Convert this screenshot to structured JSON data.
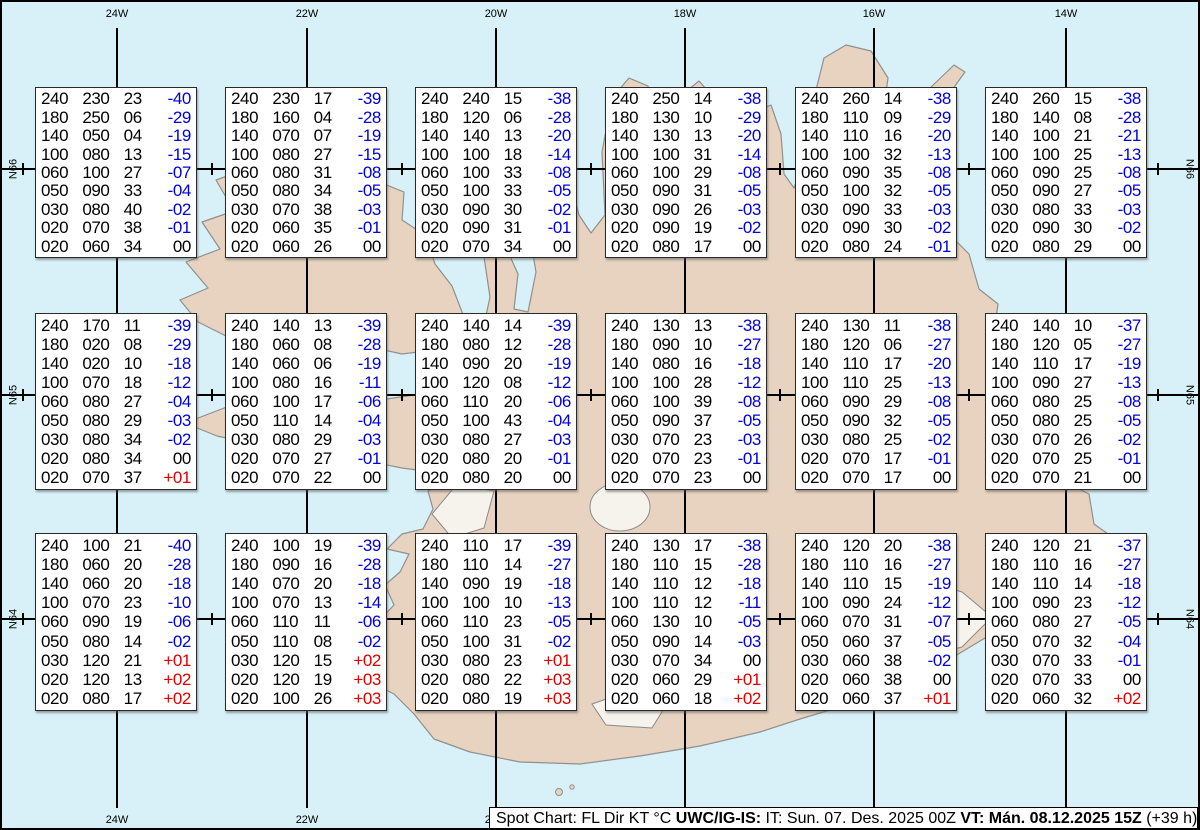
{
  "map": {
    "longitude_labels": [
      "24W",
      "22W",
      "20W",
      "18W",
      "16W",
      "14W"
    ],
    "latitude_labels": [
      "N66",
      "N65",
      "N64"
    ],
    "colors": {
      "ocean": "#d8f1f8",
      "land": "#e7d3bf",
      "coastline": "#909090",
      "glacier": "#f6f3ec",
      "grid": "#000000",
      "temp_negative": "#0000dd",
      "temp_positive": "#e00000",
      "text": "#000000"
    }
  },
  "info_bar": {
    "prefix": "Spot Chart: FL Dir KT °C ",
    "source_bold": "UWC/IG-IS:",
    "issue_time": " IT: Sun. 07. Des. 2025 00Z ",
    "valid_time_bold": "VT: Mán. 08.12.2025 15Z",
    "suffix": " (+39 h)"
  },
  "column_meaning": [
    "FL",
    "Dir",
    "KT",
    "°C"
  ],
  "spot_boxes": [
    {
      "grid": "r1c1",
      "rows": [
        [
          "240",
          "230",
          "23",
          "-40"
        ],
        [
          "180",
          "250",
          "06",
          "-29"
        ],
        [
          "140",
          "050",
          "04",
          "-19"
        ],
        [
          "100",
          "080",
          "13",
          "-15"
        ],
        [
          "060",
          "100",
          "27",
          "-07"
        ],
        [
          "050",
          "090",
          "33",
          "-04"
        ],
        [
          "030",
          "080",
          "40",
          "-02"
        ],
        [
          "020",
          "070",
          "38",
          "-01"
        ],
        [
          "020",
          "060",
          "34",
          "00"
        ]
      ]
    },
    {
      "grid": "r1c2",
      "rows": [
        [
          "240",
          "230",
          "17",
          "-39"
        ],
        [
          "180",
          "160",
          "04",
          "-28"
        ],
        [
          "140",
          "070",
          "07",
          "-19"
        ],
        [
          "100",
          "080",
          "27",
          "-15"
        ],
        [
          "060",
          "080",
          "31",
          "-08"
        ],
        [
          "050",
          "080",
          "34",
          "-05"
        ],
        [
          "030",
          "070",
          "38",
          "-03"
        ],
        [
          "020",
          "060",
          "35",
          "-01"
        ],
        [
          "020",
          "060",
          "26",
          "00"
        ]
      ]
    },
    {
      "grid": "r1c3",
      "rows": [
        [
          "240",
          "240",
          "15",
          "-38"
        ],
        [
          "180",
          "120",
          "06",
          "-28"
        ],
        [
          "140",
          "140",
          "13",
          "-20"
        ],
        [
          "100",
          "100",
          "18",
          "-14"
        ],
        [
          "060",
          "100",
          "33",
          "-08"
        ],
        [
          "050",
          "100",
          "33",
          "-05"
        ],
        [
          "030",
          "090",
          "30",
          "-02"
        ],
        [
          "020",
          "090",
          "31",
          "-01"
        ],
        [
          "020",
          "070",
          "34",
          "00"
        ]
      ]
    },
    {
      "grid": "r1c4",
      "rows": [
        [
          "240",
          "250",
          "14",
          "-38"
        ],
        [
          "180",
          "130",
          "10",
          "-29"
        ],
        [
          "140",
          "130",
          "13",
          "-20"
        ],
        [
          "100",
          "100",
          "31",
          "-14"
        ],
        [
          "060",
          "100",
          "29",
          "-08"
        ],
        [
          "050",
          "090",
          "31",
          "-05"
        ],
        [
          "030",
          "090",
          "26",
          "-03"
        ],
        [
          "020",
          "090",
          "19",
          "-02"
        ],
        [
          "020",
          "080",
          "17",
          "00"
        ]
      ]
    },
    {
      "grid": "r1c5",
      "rows": [
        [
          "240",
          "260",
          "14",
          "-38"
        ],
        [
          "180",
          "110",
          "09",
          "-29"
        ],
        [
          "140",
          "110",
          "16",
          "-20"
        ],
        [
          "100",
          "100",
          "32",
          "-13"
        ],
        [
          "060",
          "090",
          "35",
          "-08"
        ],
        [
          "050",
          "100",
          "32",
          "-05"
        ],
        [
          "030",
          "090",
          "33",
          "-03"
        ],
        [
          "020",
          "090",
          "30",
          "-02"
        ],
        [
          "020",
          "080",
          "24",
          "-01"
        ]
      ]
    },
    {
      "grid": "r1c6",
      "rows": [
        [
          "240",
          "260",
          "15",
          "-38"
        ],
        [
          "180",
          "140",
          "08",
          "-28"
        ],
        [
          "140",
          "100",
          "21",
          "-21"
        ],
        [
          "100",
          "100",
          "25",
          "-13"
        ],
        [
          "060",
          "090",
          "25",
          "-08"
        ],
        [
          "050",
          "090",
          "27",
          "-05"
        ],
        [
          "030",
          "080",
          "33",
          "-03"
        ],
        [
          "020",
          "090",
          "30",
          "-02"
        ],
        [
          "020",
          "080",
          "29",
          "00"
        ]
      ]
    },
    {
      "grid": "r2c1",
      "rows": [
        [
          "240",
          "170",
          "11",
          "-39"
        ],
        [
          "180",
          "020",
          "08",
          "-29"
        ],
        [
          "140",
          "020",
          "10",
          "-18"
        ],
        [
          "100",
          "070",
          "18",
          "-12"
        ],
        [
          "060",
          "080",
          "27",
          "-04"
        ],
        [
          "050",
          "080",
          "29",
          "-03"
        ],
        [
          "030",
          "080",
          "34",
          "-02"
        ],
        [
          "020",
          "080",
          "34",
          "00"
        ],
        [
          "020",
          "070",
          "37",
          "+01"
        ]
      ]
    },
    {
      "grid": "r2c2",
      "rows": [
        [
          "240",
          "140",
          "13",
          "-39"
        ],
        [
          "180",
          "060",
          "08",
          "-28"
        ],
        [
          "140",
          "060",
          "06",
          "-19"
        ],
        [
          "100",
          "080",
          "16",
          "-11"
        ],
        [
          "060",
          "100",
          "17",
          "-06"
        ],
        [
          "050",
          "110",
          "14",
          "-04"
        ],
        [
          "030",
          "080",
          "29",
          "-03"
        ],
        [
          "020",
          "070",
          "27",
          "-01"
        ],
        [
          "020",
          "070",
          "22",
          "00"
        ]
      ]
    },
    {
      "grid": "r2c3",
      "rows": [
        [
          "240",
          "140",
          "14",
          "-39"
        ],
        [
          "180",
          "080",
          "12",
          "-28"
        ],
        [
          "140",
          "090",
          "20",
          "-19"
        ],
        [
          "100",
          "120",
          "08",
          "-12"
        ],
        [
          "060",
          "110",
          "20",
          "-06"
        ],
        [
          "050",
          "100",
          "43",
          "-04"
        ],
        [
          "030",
          "080",
          "27",
          "-03"
        ],
        [
          "020",
          "080",
          "20",
          "-01"
        ],
        [
          "020",
          "080",
          "20",
          "00"
        ]
      ]
    },
    {
      "grid": "r2c4",
      "rows": [
        [
          "240",
          "130",
          "13",
          "-38"
        ],
        [
          "180",
          "090",
          "10",
          "-27"
        ],
        [
          "140",
          "080",
          "16",
          "-18"
        ],
        [
          "100",
          "100",
          "28",
          "-12"
        ],
        [
          "060",
          "100",
          "39",
          "-08"
        ],
        [
          "050",
          "090",
          "37",
          "-05"
        ],
        [
          "030",
          "070",
          "23",
          "-03"
        ],
        [
          "020",
          "070",
          "23",
          "-01"
        ],
        [
          "020",
          "070",
          "23",
          "00"
        ]
      ]
    },
    {
      "grid": "r2c5",
      "rows": [
        [
          "240",
          "130",
          "11",
          "-38"
        ],
        [
          "180",
          "120",
          "06",
          "-27"
        ],
        [
          "140",
          "110",
          "17",
          "-20"
        ],
        [
          "100",
          "110",
          "25",
          "-13"
        ],
        [
          "060",
          "090",
          "29",
          "-08"
        ],
        [
          "050",
          "090",
          "32",
          "-05"
        ],
        [
          "030",
          "080",
          "25",
          "-02"
        ],
        [
          "020",
          "070",
          "17",
          "-01"
        ],
        [
          "020",
          "070",
          "17",
          "00"
        ]
      ]
    },
    {
      "grid": "r2c6",
      "rows": [
        [
          "240",
          "140",
          "10",
          "-37"
        ],
        [
          "180",
          "120",
          "05",
          "-27"
        ],
        [
          "140",
          "110",
          "17",
          "-19"
        ],
        [
          "100",
          "090",
          "27",
          "-13"
        ],
        [
          "060",
          "080",
          "25",
          "-08"
        ],
        [
          "050",
          "080",
          "25",
          "-05"
        ],
        [
          "030",
          "070",
          "26",
          "-02"
        ],
        [
          "020",
          "070",
          "25",
          "-01"
        ],
        [
          "020",
          "070",
          "21",
          "00"
        ]
      ]
    },
    {
      "grid": "r3c1",
      "rows": [
        [
          "240",
          "100",
          "21",
          "-40"
        ],
        [
          "180",
          "060",
          "20",
          "-28"
        ],
        [
          "140",
          "060",
          "20",
          "-18"
        ],
        [
          "100",
          "070",
          "23",
          "-10"
        ],
        [
          "060",
          "090",
          "19",
          "-06"
        ],
        [
          "050",
          "080",
          "14",
          "-02"
        ],
        [
          "030",
          "120",
          "21",
          "+01"
        ],
        [
          "020",
          "120",
          "13",
          "+02"
        ],
        [
          "020",
          "080",
          "17",
          "+02"
        ]
      ]
    },
    {
      "grid": "r3c2",
      "rows": [
        [
          "240",
          "100",
          "19",
          "-39"
        ],
        [
          "180",
          "090",
          "16",
          "-28"
        ],
        [
          "140",
          "070",
          "20",
          "-18"
        ],
        [
          "100",
          "070",
          "13",
          "-14"
        ],
        [
          "060",
          "110",
          "11",
          "-06"
        ],
        [
          "050",
          "110",
          "08",
          "-02"
        ],
        [
          "030",
          "120",
          "15",
          "+02"
        ],
        [
          "020",
          "120",
          "19",
          "+03"
        ],
        [
          "020",
          "100",
          "26",
          "+03"
        ]
      ]
    },
    {
      "grid": "r3c3",
      "rows": [
        [
          "240",
          "110",
          "17",
          "-39"
        ],
        [
          "180",
          "110",
          "14",
          "-27"
        ],
        [
          "140",
          "090",
          "19",
          "-18"
        ],
        [
          "100",
          "100",
          "10",
          "-13"
        ],
        [
          "060",
          "110",
          "23",
          "-05"
        ],
        [
          "050",
          "100",
          "31",
          "-02"
        ],
        [
          "030",
          "080",
          "23",
          "+01"
        ],
        [
          "020",
          "080",
          "22",
          "+03"
        ],
        [
          "020",
          "080",
          "19",
          "+03"
        ]
      ]
    },
    {
      "grid": "r3c4",
      "rows": [
        [
          "240",
          "130",
          "17",
          "-38"
        ],
        [
          "180",
          "110",
          "15",
          "-28"
        ],
        [
          "140",
          "110",
          "12",
          "-18"
        ],
        [
          "100",
          "110",
          "12",
          "-11"
        ],
        [
          "060",
          "130",
          "10",
          "-05"
        ],
        [
          "050",
          "090",
          "14",
          "-03"
        ],
        [
          "030",
          "070",
          "34",
          "00"
        ],
        [
          "020",
          "060",
          "29",
          "+01"
        ],
        [
          "020",
          "060",
          "18",
          "+02"
        ]
      ]
    },
    {
      "grid": "r3c5",
      "rows": [
        [
          "240",
          "120",
          "20",
          "-38"
        ],
        [
          "180",
          "110",
          "16",
          "-27"
        ],
        [
          "140",
          "110",
          "15",
          "-19"
        ],
        [
          "100",
          "090",
          "24",
          "-12"
        ],
        [
          "060",
          "070",
          "31",
          "-07"
        ],
        [
          "050",
          "060",
          "37",
          "-05"
        ],
        [
          "030",
          "060",
          "38",
          "-02"
        ],
        [
          "020",
          "060",
          "38",
          "00"
        ],
        [
          "020",
          "060",
          "37",
          "+01"
        ]
      ]
    },
    {
      "grid": "r3c6",
      "rows": [
        [
          "240",
          "120",
          "21",
          "-37"
        ],
        [
          "180",
          "110",
          "16",
          "-27"
        ],
        [
          "140",
          "110",
          "14",
          "-18"
        ],
        [
          "100",
          "090",
          "23",
          "-12"
        ],
        [
          "060",
          "080",
          "27",
          "-05"
        ],
        [
          "050",
          "070",
          "32",
          "-04"
        ],
        [
          "030",
          "070",
          "33",
          "-01"
        ],
        [
          "020",
          "070",
          "33",
          "00"
        ],
        [
          "020",
          "060",
          "32",
          "+02"
        ]
      ]
    }
  ]
}
